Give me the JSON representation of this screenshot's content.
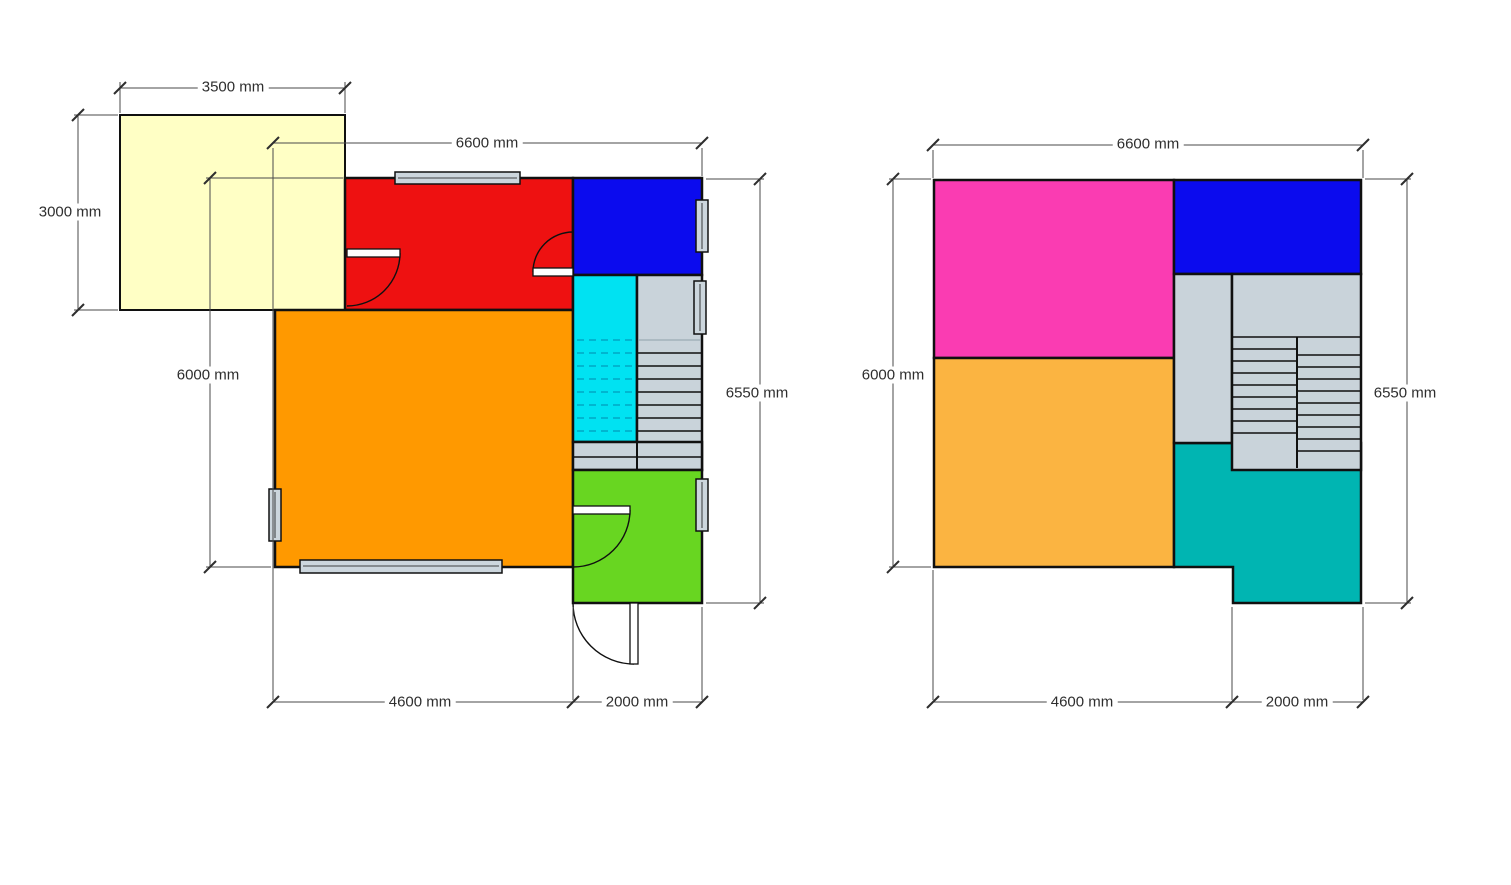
{
  "colors": {
    "wall": "#101010",
    "dim_line": "#4a4a4a",
    "dim_text": "#2e2e2e",
    "window_fill": "#ccd6dd",
    "door_leaf": "#ffffff",
    "stair_gray": "#c9d3da",
    "cyan_dash": "#00a8c4"
  },
  "left_plan": {
    "rooms": {
      "yellow": "#ffffc5",
      "red": "#ee1111",
      "blue": "#0b0bee",
      "orange": "#ff9900",
      "cyan": "#00e2f2",
      "green": "#68d621"
    },
    "dimensions": {
      "top_small": "3500 mm",
      "left_small": "3000 mm",
      "top": "6600 mm",
      "left": "6000 mm",
      "right": "6550 mm",
      "bottom_left": "4600 mm",
      "bottom_right": "2000 mm"
    }
  },
  "right_plan": {
    "rooms": {
      "pink": "#fa3cb2",
      "blue": "#0b0bee",
      "orange": "#fbb441",
      "teal": "#00b5b2"
    },
    "dimensions": {
      "top": "6600 mm",
      "left": "6000 mm",
      "right": "6550 mm",
      "bottom_left": "4600 mm",
      "bottom_right": "2000 mm"
    }
  }
}
